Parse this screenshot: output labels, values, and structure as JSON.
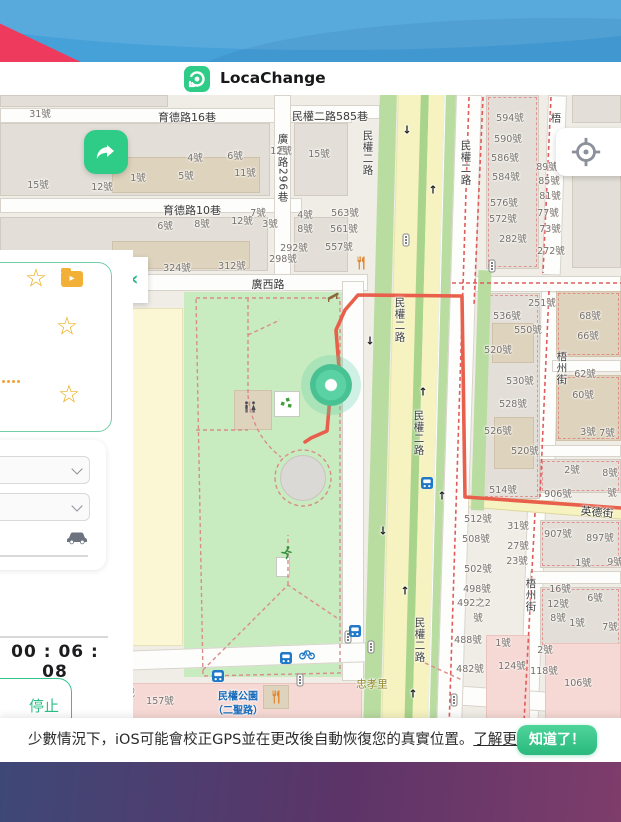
{
  "header": {
    "app_name": "LocaChange"
  },
  "colors": {
    "accent_green": "#2ecc87",
    "banner_blue": "#47a1d9",
    "banner_red": "#ee3a5d",
    "route": "#e8604c",
    "marker": "#57cfa0",
    "bus_blue": "#1f78c8",
    "star_yellow": "#eeb01f"
  },
  "sidebar": {
    "timer": "00 : 06 : 08",
    "stop_label": "停止"
  },
  "notice": {
    "text": "少數情況下，iOS可能會校正GPS並在更改後自動恢復您的真實位置。",
    "link": "了解更多.",
    "button": "知道了！"
  },
  "map": {
    "marker": {
      "x": 331,
      "y": 290
    },
    "route_points": "305,347 311,343 327,336 331,291 339,273 336,235 345,215 358,200 462,201 465,402 621,413",
    "labels": [
      [
        "育德路16巷",
        187,
        22,
        "st"
      ],
      [
        "民權二路585巷",
        330,
        21,
        "st"
      ],
      [
        "育德路10巷",
        192,
        115,
        "st"
      ],
      [
        "廣西路",
        268,
        189,
        "st"
      ],
      [
        "廣西路296巷",
        283,
        73,
        "stv"
      ],
      [
        "民權二路",
        368,
        58,
        "stv"
      ],
      [
        "民權二路",
        466,
        68,
        "stv"
      ],
      [
        "民權二路",
        400,
        225,
        "stv"
      ],
      [
        "民權二路",
        419,
        338,
        "stv"
      ],
      [
        "民權二路",
        420,
        545,
        "stv"
      ],
      [
        "梧",
        556,
        23,
        "stv"
      ],
      [
        "梧州街",
        562,
        273,
        "stv"
      ],
      [
        "梧州街",
        531,
        500,
        "stv"
      ],
      [
        "英德街",
        597,
        417,
        "st",
        5
      ],
      [
        "忠孝里",
        372,
        589,
        "area"
      ],
      [
        "民權公園",
        238,
        600,
        "busname"
      ],
      [
        "（二聖路）",
        238,
        614,
        "busname"
      ],
      [
        "31號",
        40,
        18,
        "num"
      ],
      [
        "4號",
        195,
        62,
        "num"
      ],
      [
        "6號",
        235,
        60,
        "num"
      ],
      [
        "12號",
        281,
        55,
        "num"
      ],
      [
        "15號",
        319,
        58,
        "num"
      ],
      [
        "15號",
        38,
        89,
        "num"
      ],
      [
        "12號",
        102,
        91,
        "num"
      ],
      [
        "1號",
        138,
        82,
        "num"
      ],
      [
        "5號",
        186,
        80,
        "num"
      ],
      [
        "11號",
        245,
        77,
        "num"
      ],
      [
        "6號",
        165,
        130,
        "num"
      ],
      [
        "8號",
        202,
        128,
        "num"
      ],
      [
        "12號",
        242,
        125,
        "num"
      ],
      [
        "3號",
        270,
        128,
        "num"
      ],
      [
        "7號",
        258,
        117,
        "num"
      ],
      [
        "4號",
        305,
        119,
        "num"
      ],
      [
        "563號",
        345,
        117,
        "num"
      ],
      [
        "8號",
        305,
        133,
        "num"
      ],
      [
        "561號",
        344,
        133,
        "num"
      ],
      [
        "557號",
        339,
        151,
        "num"
      ],
      [
        "292號",
        294,
        152,
        "num"
      ],
      [
        "324號",
        177,
        172,
        "num"
      ],
      [
        "312號",
        232,
        170,
        "num"
      ],
      [
        "298號",
        283,
        163,
        "num"
      ],
      [
        "594號",
        510,
        22,
        "num"
      ],
      [
        "590號",
        508,
        43,
        "num"
      ],
      [
        "586號",
        505,
        62,
        "num"
      ],
      [
        "584號",
        506,
        81,
        "num"
      ],
      [
        "576號",
        504,
        107,
        "num"
      ],
      [
        "572號",
        503,
        123,
        "num"
      ],
      [
        "282號",
        513,
        143,
        "num"
      ],
      [
        "89號",
        547,
        71,
        "num"
      ],
      [
        "85號",
        549,
        85,
        "num"
      ],
      [
        "81號",
        550,
        100,
        "num"
      ],
      [
        "77號",
        548,
        117,
        "num"
      ],
      [
        "73號",
        550,
        133,
        "num"
      ],
      [
        "272號",
        551,
        155,
        "num"
      ],
      [
        "251號",
        542,
        207,
        "num"
      ],
      [
        "536號",
        507,
        220,
        "num"
      ],
      [
        "550號",
        528,
        234,
        "num"
      ],
      [
        "520號",
        498,
        254,
        "num"
      ],
      [
        "530號",
        520,
        285,
        "num"
      ],
      [
        "528號",
        513,
        308,
        "num"
      ],
      [
        "526號",
        498,
        335,
        "num"
      ],
      [
        "520號",
        525,
        355,
        "num"
      ],
      [
        "514號",
        503,
        394,
        "num"
      ],
      [
        "68號",
        590,
        220,
        "num"
      ],
      [
        "66號",
        588,
        240,
        "num"
      ],
      [
        "62號",
        585,
        278,
        "num"
      ],
      [
        "60號",
        583,
        299,
        "num"
      ],
      [
        "3號",
        588,
        336,
        "num"
      ],
      [
        "7號",
        607,
        337,
        "num"
      ],
      [
        "2號",
        572,
        374,
        "num"
      ],
      [
        "8號",
        610,
        377,
        "num"
      ],
      [
        "906號",
        558,
        398,
        "num"
      ],
      [
        "號",
        612,
        397,
        "num"
      ],
      [
        "512號",
        478,
        423,
        "num"
      ],
      [
        "31號",
        518,
        430,
        "num"
      ],
      [
        "508號",
        476,
        443,
        "num"
      ],
      [
        "27號",
        518,
        450,
        "num"
      ],
      [
        "23號",
        517,
        465,
        "num"
      ],
      [
        "502號",
        478,
        473,
        "num"
      ],
      [
        "498號",
        477,
        493,
        "num"
      ],
      [
        "492之2",
        474,
        507,
        "num"
      ],
      [
        "號",
        478,
        522,
        "num"
      ],
      [
        "907號",
        558,
        438,
        "num"
      ],
      [
        "897號",
        600,
        442,
        "num"
      ],
      [
        "1號",
        583,
        467,
        "num"
      ],
      [
        "9號",
        615,
        466,
        "num"
      ],
      [
        "16號",
        560,
        493,
        "num"
      ],
      [
        "12號",
        558,
        508,
        "num"
      ],
      [
        "6號",
        595,
        502,
        "num"
      ],
      [
        "8號",
        558,
        522,
        "num"
      ],
      [
        "1號",
        577,
        527,
        "num"
      ],
      [
        "7號",
        610,
        531,
        "num"
      ],
      [
        "488號",
        468,
        544,
        "num"
      ],
      [
        "1號",
        503,
        547,
        "num"
      ],
      [
        "482號",
        470,
        573,
        "num"
      ],
      [
        "124號",
        512,
        570,
        "num"
      ],
      [
        "2號",
        545,
        554,
        "num"
      ],
      [
        "118號",
        544,
        575,
        "num"
      ],
      [
        "106號",
        578,
        587,
        "num"
      ],
      [
        "157號",
        160,
        605,
        "num"
      ],
      [
        "號",
        130,
        597,
        "num"
      ]
    ],
    "icons": [
      [
        "traffic-light",
        406,
        145
      ],
      [
        "traffic-light",
        492,
        171
      ],
      [
        "traffic-light",
        348,
        542
      ],
      [
        "traffic-light",
        371,
        552
      ],
      [
        "traffic-light",
        300,
        585
      ],
      [
        "traffic-light",
        454,
        605
      ],
      [
        "bus",
        427,
        388
      ],
      [
        "bus",
        355,
        536
      ],
      [
        "bus",
        286,
        563
      ],
      [
        "bus",
        218,
        581
      ],
      [
        "bike",
        307,
        559
      ],
      [
        "restaurant",
        361,
        168
      ],
      [
        "restaurant",
        276,
        602
      ],
      [
        "toilets",
        250,
        312
      ],
      [
        "playground",
        287,
        308
      ],
      [
        "fitness",
        286,
        458
      ],
      [
        "bench",
        333,
        202
      ]
    ],
    "arrows": [
      [
        "↓",
        407,
        35
      ],
      [
        "↑",
        433,
        95
      ],
      [
        "↓",
        370,
        246
      ],
      [
        "↑",
        423,
        297
      ],
      [
        "↑",
        442,
        401
      ],
      [
        "↓",
        383,
        436
      ],
      [
        "↑",
        405,
        496
      ],
      [
        "↑",
        413,
        599
      ]
    ]
  }
}
